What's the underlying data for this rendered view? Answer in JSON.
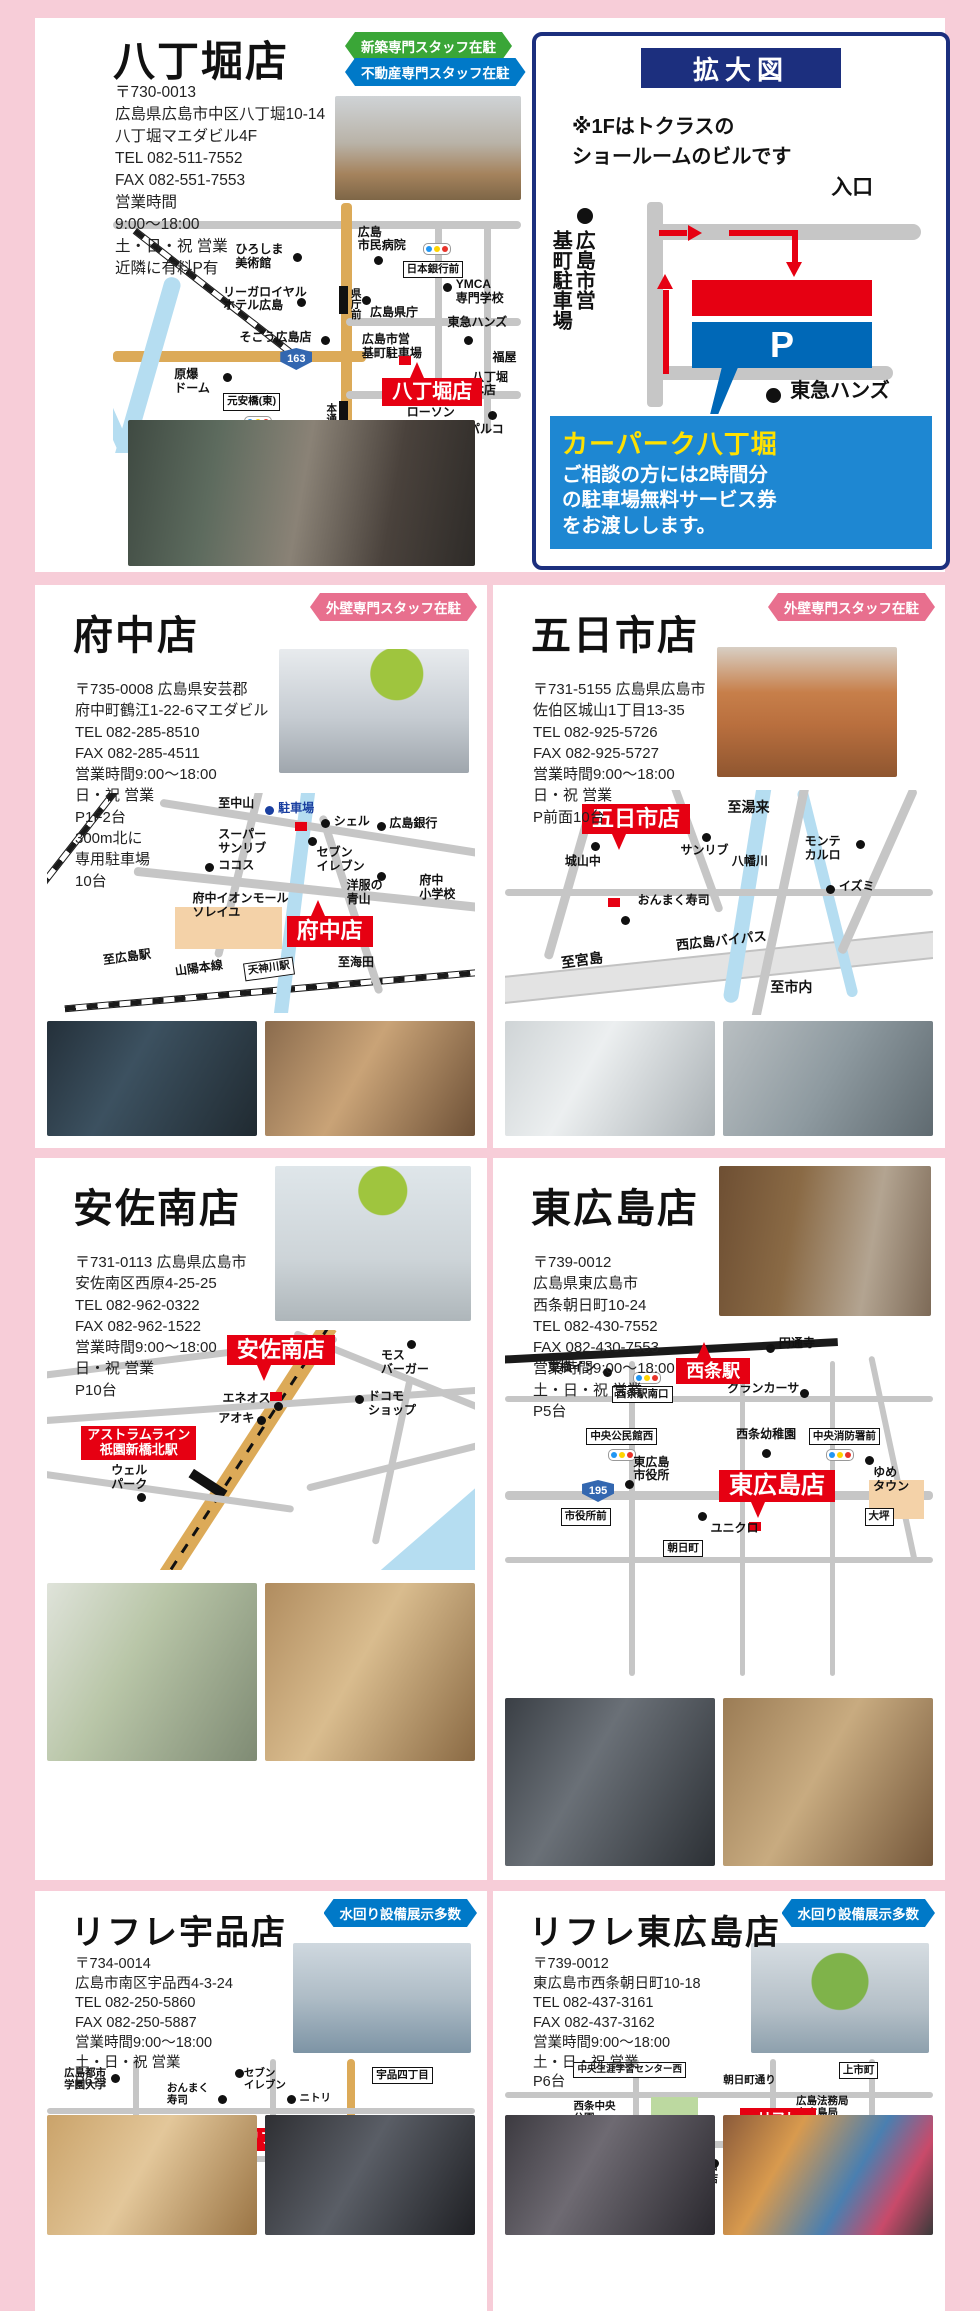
{
  "colors": {
    "page_bg": "#f7cdd8",
    "brand_red": "#e60012",
    "navy": "#1c2f7e",
    "parking_blue": "#0068b7",
    "notice_blue": "#1e87d2",
    "badge_green": "#3aa637",
    "badge_blue": "#0079c8",
    "badge_pink": "#e86f8e",
    "highlight_yellow": "#ffe100"
  },
  "hatchobori": {
    "title": "八丁堀店",
    "badge1": "新築専門スタッフ在駐",
    "badge2": "不動産専門スタッフ在駐",
    "lines": [
      "〒730-0013",
      "広島県広島市中区八丁堀10-14",
      "八丁堀マエダビル4F",
      "TEL 082-511-7552",
      "FAX 082-551-7553",
      "営業時間",
      "9:00〜18:00",
      "土・日・祝 営業",
      "近隣に有料P有"
    ],
    "map": {
      "flag": "八丁堀店",
      "route": "163",
      "m1": "ひろしま\n美術館",
      "m2": "広島\n市民病院",
      "m3": "日本銀行前",
      "m4": "YMCA\n専門学校",
      "m5": "リーガロイヤル\nホテル広島",
      "m6": "県庁前",
      "m7": "広島県庁",
      "m8": "そごう広島店",
      "m9": "広島市営\n基町駐車場",
      "m10": "東急ハンズ",
      "m11": "原爆\nドーム",
      "m12": "元安橋(東)",
      "m13": "福屋",
      "m14": "八丁堀\n本店",
      "m15": "ローソン",
      "m16": "パルコ",
      "m17": "本通",
      "m18": "ユアーズ"
    }
  },
  "kakudai": {
    "title": "拡大図",
    "note": "※1Fはトクラスの\nショールームのビルです",
    "entrance": "入口",
    "parking": "広島市営\n基町駐車場",
    "p": "P",
    "tokyu": "東急ハンズ",
    "carpark": "カーパーク八丁堀",
    "notice": "ご相談の方には2時間分\nの駐車場無料サービス券\nをお渡しします。"
  },
  "fuchu": {
    "title": "府中店",
    "badge": "外壁専門スタッフ在駐",
    "lines": [
      "〒735-0008 広島県安芸郡",
      "府中町鶴江1-22-6マエダビル",
      "TEL 082-285-8510",
      "FAX 082-285-4511",
      "営業時間9:00〜18:00",
      "日・祝 営業",
      "P1F2台",
      "300m北に",
      "専用駐車場",
      "10台"
    ],
    "map": {
      "flag": "府中店",
      "m1": "至中山",
      "m2": "駐車場",
      "m3": "スーパー\nサンリブ",
      "m4": "シェル",
      "m5": "広島銀行",
      "m6": "ココス",
      "m7": "セブン\nイレブン",
      "m8": "洋服の\n青山",
      "m9": "府中\n小学校",
      "m10": "府中イオンモール\nソレイユ",
      "m11": "至広島駅",
      "m12": "山陽本線",
      "m13": "天神川駅",
      "m14": "至海田"
    }
  },
  "itsukaichi": {
    "title": "五日市店",
    "badge": "外壁専門スタッフ在駐",
    "lines": [
      "〒731-5155 広島県広島市",
      "佐伯区城山1丁目13-35",
      "TEL 082-925-5726",
      "FAX 082-925-5727",
      "営業時間9:00〜18:00",
      "日・祝 営業",
      "P前面10台"
    ],
    "map": {
      "flag": "五日市店",
      "m1": "至湯来",
      "m2": "モンテ\nカルロ",
      "m3": "城山中",
      "m4": "サンリブ",
      "m5": "八幡川",
      "m6": "イズミ",
      "m7": "おんまく寿司",
      "m8": "西広島バイパス",
      "m9": "至宮島",
      "m10": "至市内"
    }
  },
  "asaminami": {
    "title": "安佐南店",
    "lines": [
      "〒731-0113 広島県広島市",
      "安佐南区西原4-25-25",
      "TEL 082-962-0322",
      "FAX 082-962-1522",
      "営業時間9:00〜18:00",
      "日・祝 営業",
      "P10台"
    ],
    "map": {
      "flag": "安佐南店",
      "m1": "モス\nバーガー",
      "m2": "エネオス",
      "m3": "ドコモ\nショップ",
      "m4": "アオキ",
      "m5": "アストラムライン\n祇園新橋北駅",
      "m6": "ウェル\nパーク"
    }
  },
  "higashihiroshima": {
    "title": "東広島店",
    "lines": [
      "〒739-0012",
      "広島県東広島市",
      "西条朝日町10-24",
      "TEL 082-430-7552",
      "FAX 082-430-7553",
      "営業時間9:00〜18:00",
      "土・日・祝 営業",
      "P5台"
    ],
    "map": {
      "flag": "東広島店",
      "flag2": "西条駅",
      "route": "195",
      "m1": "円通寺",
      "m2": "東横イン",
      "m3": "西条駅南口",
      "m4": "グランカーサ",
      "m5": "中央公民館西",
      "m6": "西条幼稚園",
      "m7": "中央消防署前",
      "m8": "東広島\n市役所",
      "m9": "ゆめ\nタウン",
      "m10": "ユニクロ",
      "m11": "朝日町",
      "m12": "大坪",
      "m13": "市役所前"
    }
  },
  "refre_ujina": {
    "title": "リフレ宇品店",
    "badge": "水回り設備展示多数",
    "lines": [
      "〒734-0014",
      "広島市南区宇品西4-3-24",
      "TEL 082-250-5860",
      "FAX 082-250-5887",
      "営業時間9:00〜18:00",
      "土・日・祝 営業",
      "P6台"
    ],
    "map": {
      "flag": "リフレ宇品店",
      "route": "482",
      "m1": "広島都市\n学園大学",
      "m2": "おんまく\n寿司",
      "m3": "セブン\nイレブン",
      "m4": "ニトリ",
      "m5": "宇品四丁目",
      "m6": "宇品五丁目",
      "m7": "フレスタ",
      "m8": "コーナン",
      "m9": "出島保育園"
    }
  },
  "refre_higashi": {
    "title": "リフレ東広島店",
    "badge": "水回り設備展示多数",
    "lines": [
      "〒739-0012",
      "東広島市西条朝日町10-18",
      "TEL 082-437-3161",
      "FAX 082-437-3162",
      "営業時間9:00〜18:00",
      "土・日・祝 営業",
      "P6台"
    ],
    "map": {
      "flag": "リフレ\n東広島店",
      "route": "195",
      "m1": "中央生涯学習センター西",
      "m2": "上市町",
      "m3": "朝日町通り",
      "m4": "西条中央\n公園",
      "m5": "広島法務局\n東広島局",
      "m6": "市役所西",
      "m7": "東広島\n市役所",
      "m8": "やまや\n西条店",
      "m9": "ユニクロ\n東広島店",
      "m10": "朝日町",
      "m11": "大坪"
    }
  }
}
